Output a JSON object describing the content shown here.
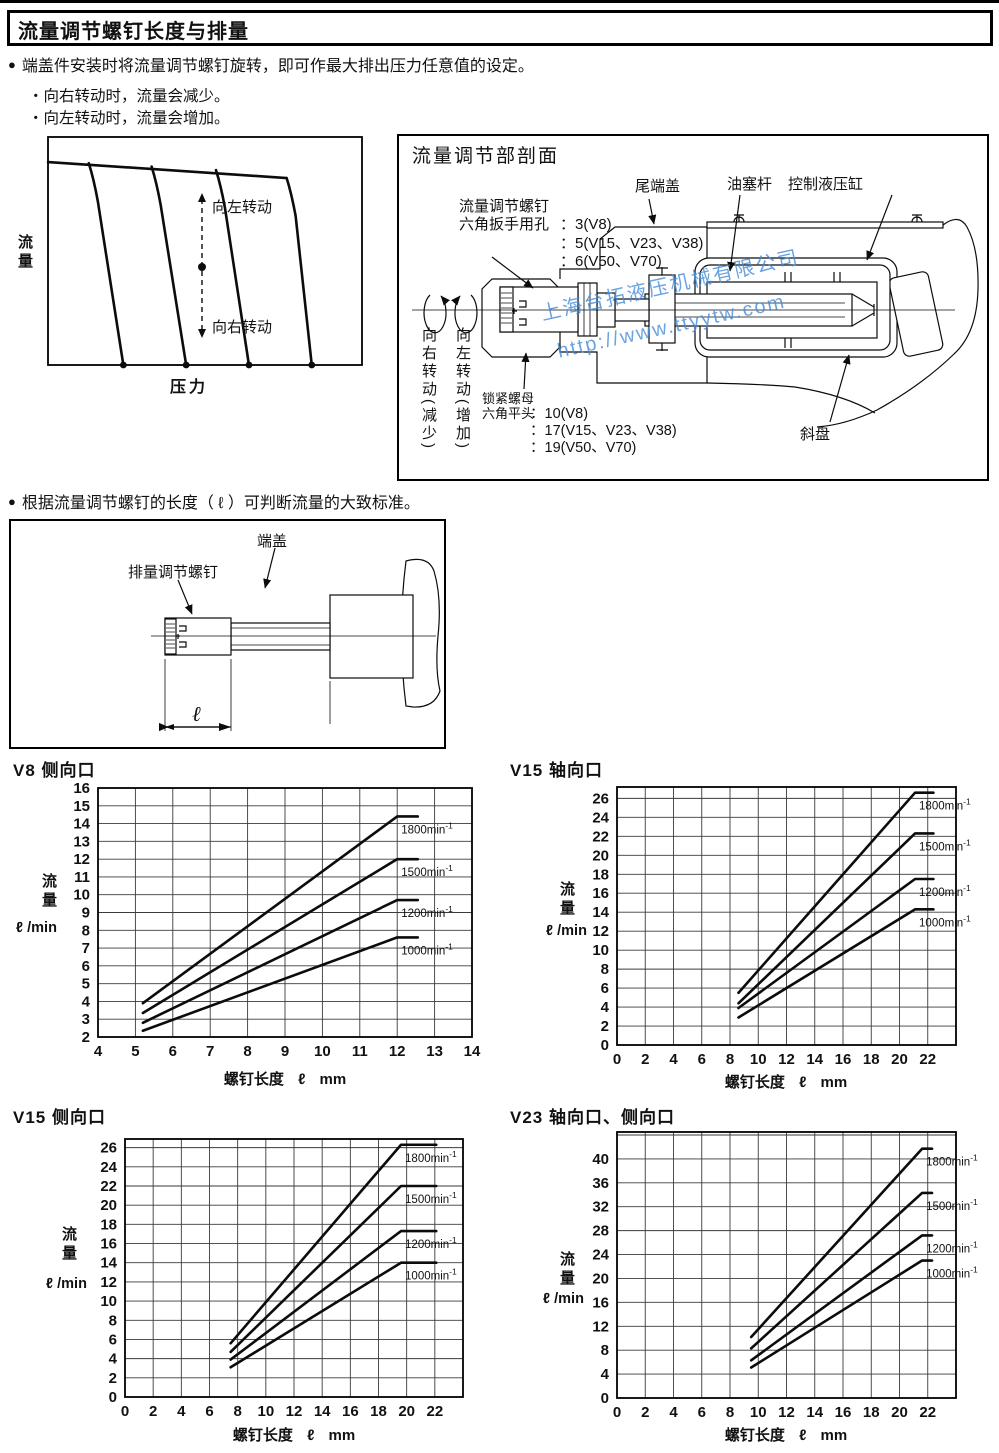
{
  "header": {
    "title": "流量调节螺钉长度与排量"
  },
  "intro": {
    "bullet1": "端盖件安装时将流量调节螺钉旋转，即可作最大排出压力任意值的设定。",
    "sub1": "・向右转动时，流量会减少。",
    "sub2": "・向左转动时，流量会增加。",
    "bullet2": "根据流量调节螺钉的长度（ ℓ ）可判断流量的大致标准。"
  },
  "section_view": {
    "title": "流量调节部剖面",
    "tail_cover": "尾端盖",
    "plug_rod": "油塞杆",
    "control_cylinder": "控制液压缸",
    "swash_plate": "斜盘",
    "screw_note": {
      "l1": "流量调节螺钉",
      "l2a": "六角扳手用孔",
      "l2b": "：3(V8)",
      "l3": "：5(V15、V23、V38)",
      "l4": "：6(V50、V70)"
    },
    "nut_note": {
      "l1": "锁紧螺母",
      "l2a": "六角平头",
      "l2b": "：10(V8)",
      "l3": "：17(V15、V23、V38)",
      "l4": "：19(V50、V70)"
    },
    "turn_right_col": "向右转动(减少)",
    "turn_left_col": "向左转动(增加)",
    "watermark": {
      "line1": "上海台拓液压机械有限公司",
      "line2": "http://www.ttyytw.com",
      "color": "rgba(70,140,216,0.8)"
    }
  },
  "screw_figure": {
    "end_cover": "端盖",
    "screw": "排量调节螺钉",
    "dim": "ℓ"
  },
  "chart_data": [
    {
      "id": "pq-concept",
      "type": "line",
      "title": "",
      "xlabel": "压力",
      "ylabel": "流量",
      "arrow_up_label": "向左转动",
      "arrow_down_label": "向右转动",
      "top_line": [
        [
          0,
          0.89
        ],
        [
          0.76,
          0.82
        ]
      ],
      "drops": [
        {
          "branch": [
            0.13,
            0.885
          ],
          "dot_x": 0.24
        },
        {
          "branch": [
            0.33,
            0.87
          ],
          "dot_x": 0.44
        },
        {
          "branch": [
            0.535,
            0.855
          ],
          "dot_x": 0.64
        },
        {
          "branch": [
            0.76,
            0.82
          ],
          "dot_x": 0.84
        }
      ]
    },
    {
      "id": "v8-side",
      "type": "line",
      "title": "V8 侧向口",
      "xlabel": "螺钉长度 ℓ mm",
      "ylabel_cn": "流量",
      "ylabel_unit": "ℓ /min",
      "x_box": [
        4,
        14
      ],
      "y_box": [
        2,
        16
      ],
      "x_grid": [
        4,
        5,
        6,
        7,
        8,
        9,
        10,
        11,
        12,
        13,
        14
      ],
      "x_labels": [
        4,
        5,
        6,
        7,
        8,
        9,
        10,
        11,
        12,
        13,
        14
      ],
      "y_grid": [
        2,
        3,
        4,
        5,
        6,
        7,
        8,
        9,
        10,
        11,
        12,
        13,
        14,
        15,
        16
      ],
      "y_labels": [
        2,
        3,
        4,
        5,
        6,
        7,
        8,
        9,
        10,
        11,
        12,
        13,
        14,
        15,
        16
      ],
      "series": [
        {
          "label": "1800",
          "unit": "min",
          "exp": "-1",
          "x": [
            5.2,
            12.0,
            12.55
          ],
          "y": [
            3.9,
            14.4,
            14.4
          ]
        },
        {
          "label": "1500",
          "unit": "min",
          "exp": "-1",
          "x": [
            5.2,
            12.0,
            12.55
          ],
          "y": [
            3.35,
            12.0,
            12.0
          ]
        },
        {
          "label": "1200",
          "unit": "min",
          "exp": "-1",
          "x": [
            5.2,
            12.0,
            12.55
          ],
          "y": [
            2.8,
            9.7,
            9.7
          ]
        },
        {
          "label": "1000",
          "unit": "min",
          "exp": "-1",
          "x": [
            5.2,
            12.0,
            12.55
          ],
          "y": [
            2.35,
            7.6,
            7.6
          ]
        }
      ]
    },
    {
      "id": "v15-axial",
      "type": "line",
      "title": "V15 轴向口",
      "xlabel": "螺钉长度 ℓ mm",
      "ylabel_cn": "流量",
      "ylabel_unit": "ℓ /min",
      "x_box": [
        0,
        24
      ],
      "y_box": [
        0,
        27.2
      ],
      "x_grid": [
        0,
        2,
        4,
        6,
        8,
        10,
        12,
        14,
        16,
        18,
        20,
        22
      ],
      "x_labels": [
        0,
        2,
        4,
        6,
        8,
        10,
        12,
        14,
        16,
        18,
        20,
        22
      ],
      "y_grid": [
        0,
        2,
        4,
        6,
        8,
        10,
        12,
        14,
        16,
        18,
        20,
        22,
        24,
        26
      ],
      "y_labels": [
        0,
        2,
        4,
        6,
        8,
        10,
        12,
        14,
        16,
        18,
        20,
        22,
        24,
        26
      ],
      "series": [
        {
          "label": "1800",
          "unit": "min",
          "exp": "-1",
          "x": [
            8.6,
            21.1,
            22.4
          ],
          "y": [
            5.5,
            26.6,
            26.6
          ]
        },
        {
          "label": "1500",
          "unit": "min",
          "exp": "-1",
          "x": [
            8.6,
            21.1,
            22.4
          ],
          "y": [
            4.4,
            22.3,
            22.3
          ]
        },
        {
          "label": "1200",
          "unit": "min",
          "exp": "-1",
          "x": [
            8.6,
            21.1,
            22.4
          ],
          "y": [
            3.9,
            17.5,
            17.5
          ]
        },
        {
          "label": "1000",
          "unit": "min",
          "exp": "-1",
          "x": [
            8.6,
            21.1,
            22.4
          ],
          "y": [
            2.9,
            14.3,
            14.3
          ]
        }
      ]
    },
    {
      "id": "v15-side",
      "type": "line",
      "title": "V15 侧向口",
      "xlabel": "螺钉长度 ℓ mm",
      "ylabel_cn": "流量",
      "ylabel_unit": "ℓ /min",
      "x_box": [
        0,
        24
      ],
      "y_box": [
        0,
        26.9
      ],
      "x_grid": [
        0,
        2,
        4,
        6,
        8,
        10,
        12,
        14,
        16,
        18,
        20,
        22
      ],
      "x_labels": [
        0,
        2,
        4,
        6,
        8,
        10,
        12,
        14,
        16,
        18,
        20,
        22
      ],
      "y_grid": [
        0,
        2,
        4,
        6,
        8,
        10,
        12,
        14,
        16,
        18,
        20,
        22,
        24,
        26
      ],
      "y_labels": [
        0,
        2,
        4,
        6,
        8,
        10,
        12,
        14,
        16,
        18,
        20,
        22,
        24,
        26
      ],
      "series": [
        {
          "label": "1800",
          "unit": "min",
          "exp": "-1",
          "x": [
            7.5,
            19.6,
            22.1
          ],
          "y": [
            5.6,
            26.3,
            26.3
          ]
        },
        {
          "label": "1500",
          "unit": "min",
          "exp": "-1",
          "x": [
            7.5,
            19.6,
            22.1
          ],
          "y": [
            4.7,
            22.0,
            22.0
          ]
        },
        {
          "label": "1200",
          "unit": "min",
          "exp": "-1",
          "x": [
            7.5,
            19.6,
            22.1
          ],
          "y": [
            3.9,
            17.3,
            17.3
          ]
        },
        {
          "label": "1000",
          "unit": "min",
          "exp": "-1",
          "x": [
            7.5,
            19.6,
            22.1
          ],
          "y": [
            3.1,
            14.0,
            14.0
          ]
        }
      ]
    },
    {
      "id": "v23-axial-side",
      "type": "line",
      "title": "V23 轴向口、侧向口",
      "xlabel": "螺钉长度 ℓ mm",
      "ylabel_cn": "流量",
      "ylabel_unit": "ℓ /min",
      "x_box": [
        0,
        24
      ],
      "y_box": [
        0,
        44.5
      ],
      "x_grid": [
        0,
        2,
        4,
        6,
        8,
        10,
        12,
        14,
        16,
        18,
        20,
        22
      ],
      "x_labels": [
        0,
        2,
        4,
        6,
        8,
        10,
        12,
        14,
        16,
        18,
        20,
        22
      ],
      "y_grid": [
        0,
        4,
        8,
        12,
        16,
        20,
        24,
        28,
        32,
        36,
        40,
        44
      ],
      "y_labels": [
        0,
        4,
        8,
        12,
        16,
        20,
        24,
        28,
        32,
        36,
        40
      ],
      "series": [
        {
          "label": "1800",
          "unit": "min",
          "exp": "-1",
          "x": [
            9.5,
            21.6,
            22.3
          ],
          "y": [
            10.2,
            41.7,
            41.7
          ]
        },
        {
          "label": "1500",
          "unit": "min",
          "exp": "-1",
          "x": [
            9.5,
            21.6,
            22.3
          ],
          "y": [
            8.3,
            34.3,
            34.3
          ]
        },
        {
          "label": "1200",
          "unit": "min",
          "exp": "-1",
          "x": [
            9.5,
            21.6,
            22.3
          ],
          "y": [
            6.3,
            27.2,
            27.2
          ]
        },
        {
          "label": "1000",
          "unit": "min",
          "exp": "-1",
          "x": [
            9.5,
            21.6,
            22.3
          ],
          "y": [
            5.1,
            23.0,
            23.0
          ]
        }
      ]
    }
  ]
}
